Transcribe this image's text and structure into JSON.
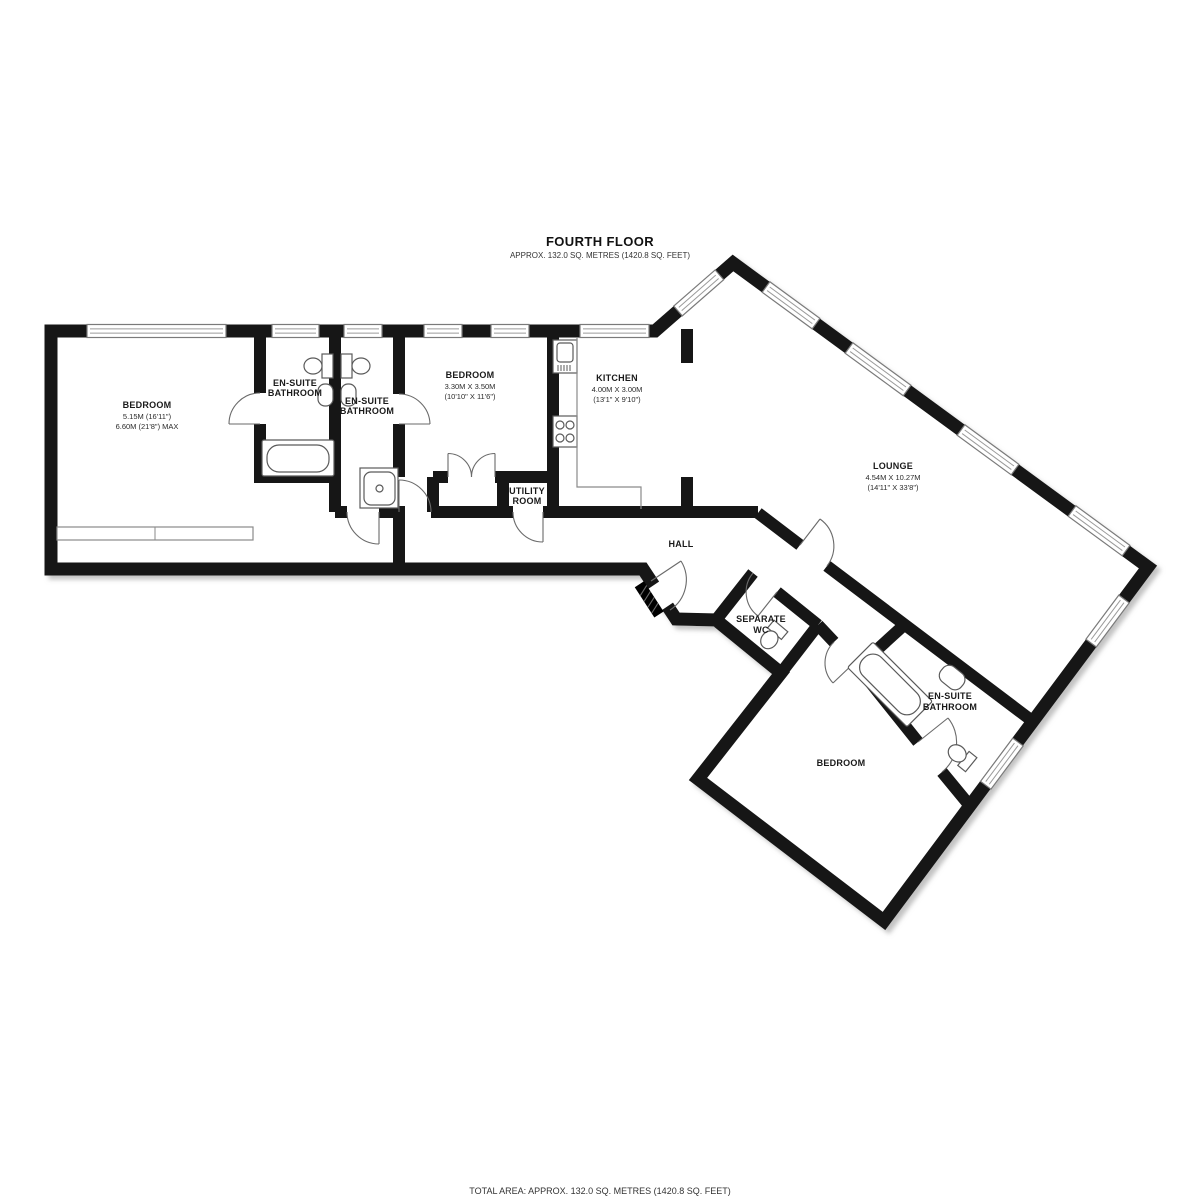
{
  "header": {
    "title": "FOURTH FLOOR",
    "subtitle": "APPROX. 132.0 SQ. METRES (1420.8 SQ. FEET)"
  },
  "footer": {
    "total_area": "TOTAL AREA: APPROX. 132.0 SQ. METRES (1420.8 SQ. FEET)"
  },
  "colors": {
    "wall": "#141414",
    "window_line": "#9a9a9a",
    "fixture_line": "#5a5a5a",
    "text": "#1a1a1a",
    "background": "#ffffff"
  },
  "rooms": {
    "bedroom_left": {
      "name": "BEDROOM",
      "dim_metric": "5.15M (16'11\")",
      "dim_note": "6.60M (21'8\") MAX"
    },
    "ensuite_left": {
      "name_line1": "EN-SUITE",
      "name_line2": "BATHROOM"
    },
    "ensuite_middle": {
      "name_line1": "EN-SUITE",
      "name_line2": "BATHROOM"
    },
    "bedroom_middle": {
      "name": "BEDROOM",
      "dim_metric": "3.30M X 3.50M",
      "dim_imperial": "(10'10\" X 11'6\")"
    },
    "kitchen": {
      "name": "KITCHEN",
      "dim_metric": "4.00M X 3.00M",
      "dim_imperial": "(13'1\" X 9'10\")"
    },
    "lounge": {
      "name": "LOUNGE",
      "dim_metric": "4.54M X 10.27M",
      "dim_imperial": "(14'11\" X 33'8\")"
    },
    "hall": {
      "name": "HALL"
    },
    "utility_room": {
      "name_line1": "UTILITY",
      "name_line2": "ROOM"
    },
    "separate_wc": {
      "name_line1": "SEPARATE",
      "name_line2": "WC"
    },
    "ensuite_bottom": {
      "name_line1": "EN-SUITE",
      "name_line2": "BATHROOM"
    },
    "bedroom_bottom": {
      "name": "BEDROOM"
    }
  }
}
